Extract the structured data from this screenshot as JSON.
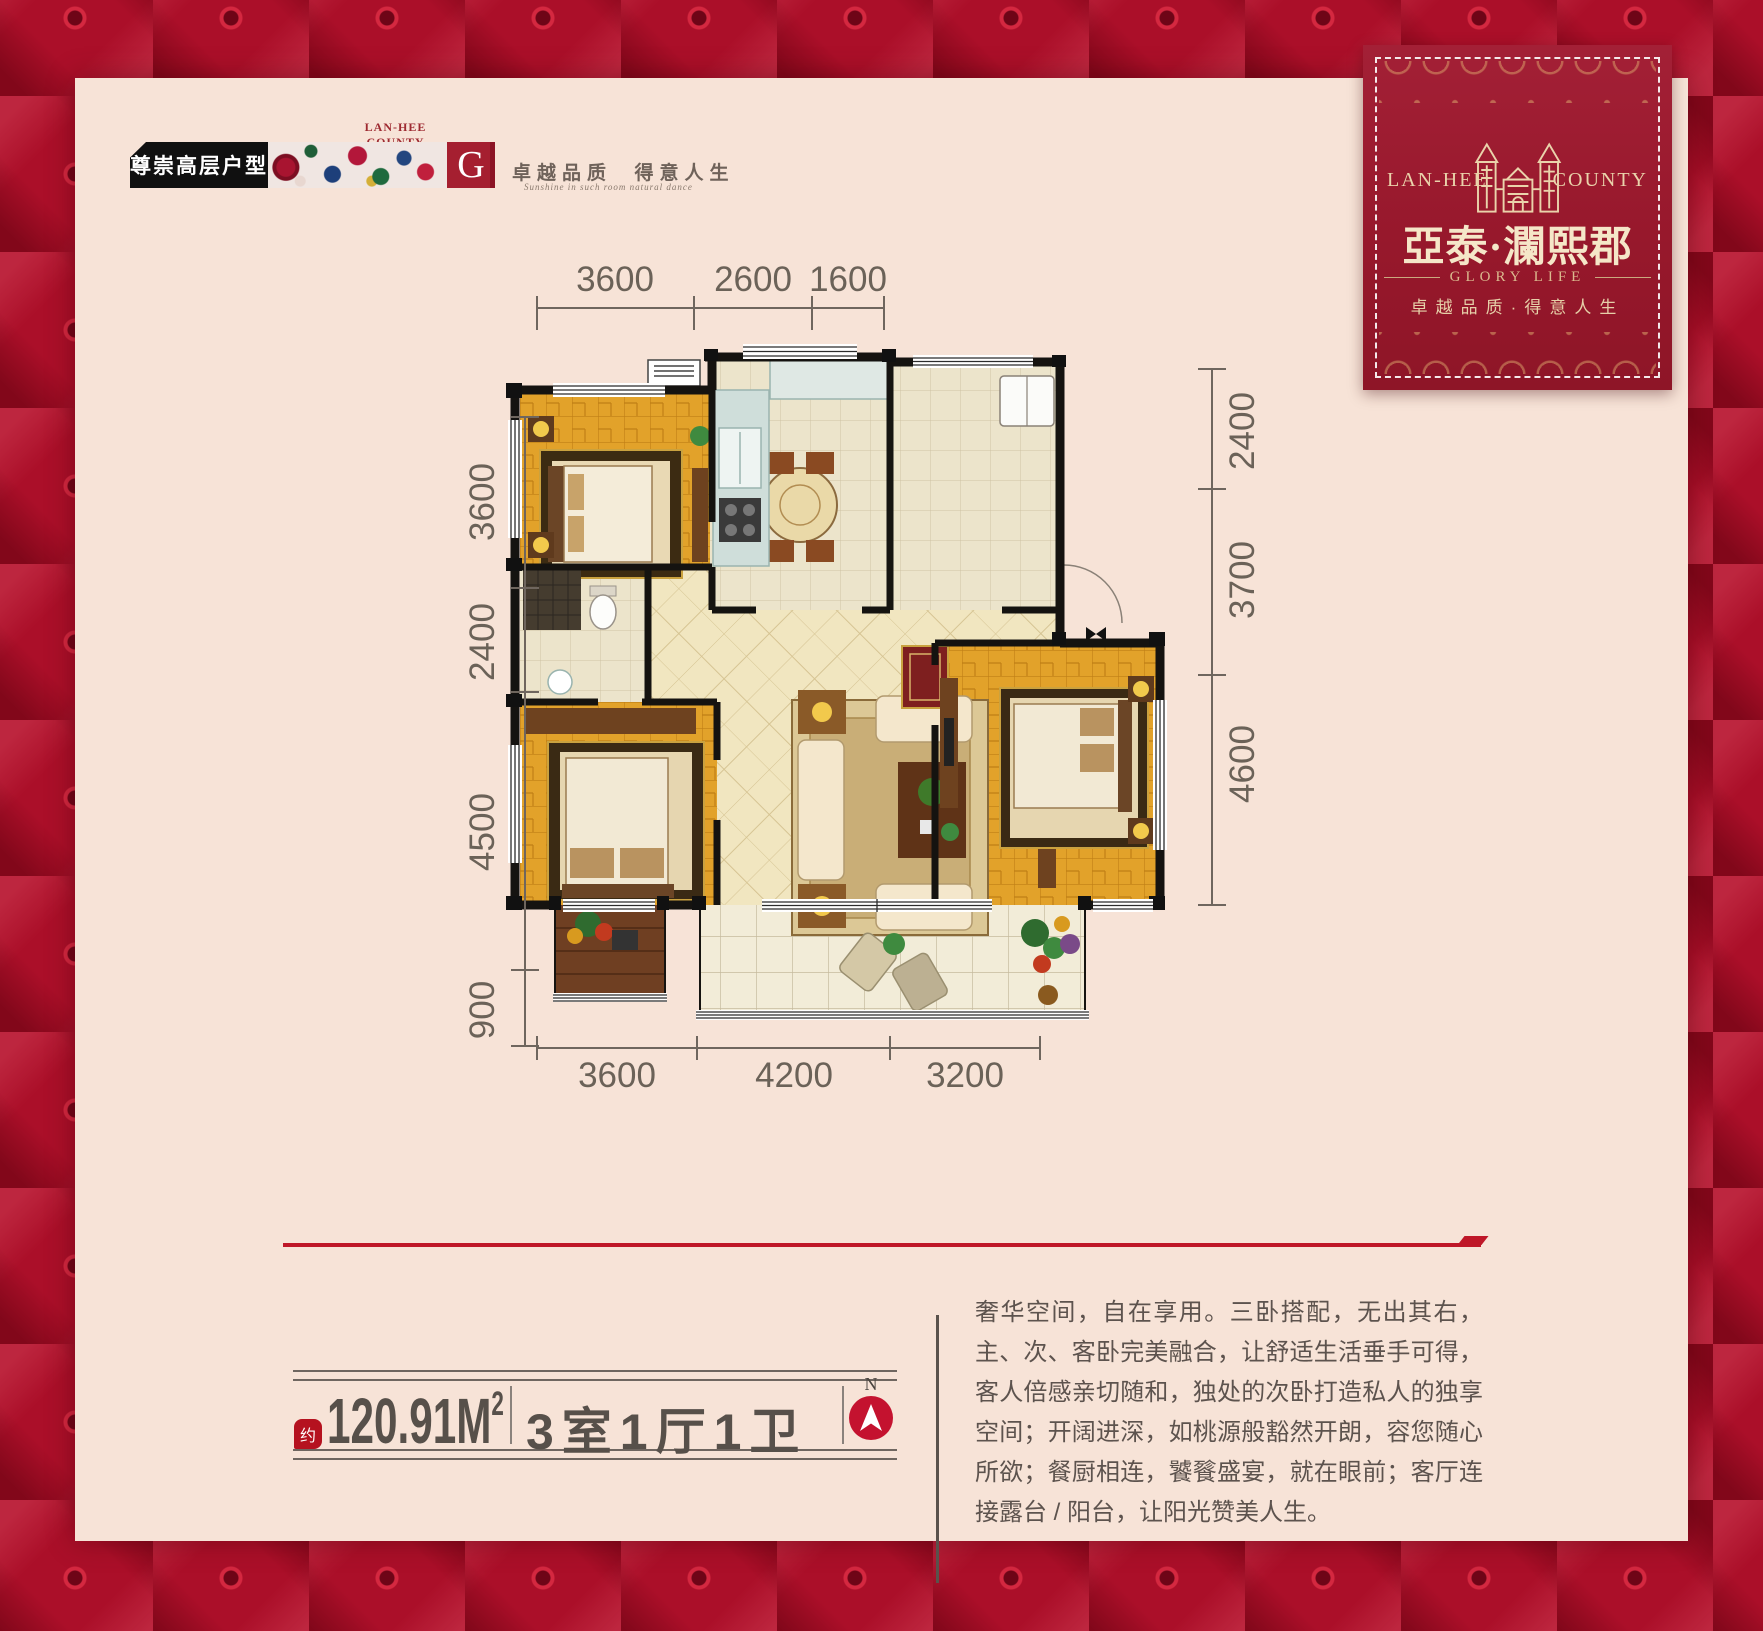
{
  "badge": {
    "tag_label": "尊崇高层户型",
    "brand_small": "LAN-HEE COUNTY",
    "unit_letter": "G",
    "slogan_cn": "卓越品质  得意人生",
    "slogan_script": "Sunshine in such room natural dance"
  },
  "brand_card": {
    "brand_left": "LAN-HEE",
    "brand_right": "COUNTY",
    "project_name": "亞泰·瀾熙郡",
    "subtitle_en": "GLORY LIFE",
    "slogan": "卓越品质·得意人生"
  },
  "floor_plan": {
    "dims_top": [
      "3600",
      "2600",
      "1600"
    ],
    "dims_left": [
      "3600",
      "2400",
      "4500",
      "900"
    ],
    "dims_right": [
      "2400",
      "3700",
      "4600"
    ],
    "dims_bottom": [
      "3600",
      "4200",
      "3200"
    ]
  },
  "info_bar": {
    "approx_label": "约",
    "area_value": "120.91M",
    "area_exponent": "2",
    "layout_text": "3室1厅1卫",
    "compass_north": "N"
  },
  "description_text": "奢华空间，自在享用。三卧搭配，无出其右，主、次、客卧完美融合，让舒适生活垂手可得，客人倍感亲切随和，独处的次卧打造私人的独享空间；开阔进深，如桃源般豁然开朗，容您随心所欲；餐厨相连，饕餮盛宴，就在眼前；客厅连接露台 / 阳台，让阳光赞美人生。",
  "colors": {
    "border_red": "#ab0f29",
    "panel_cream": "#f7e3d7",
    "card_red": "#97182c",
    "accent_red": "#bf1728",
    "ink": "#5d534e"
  }
}
